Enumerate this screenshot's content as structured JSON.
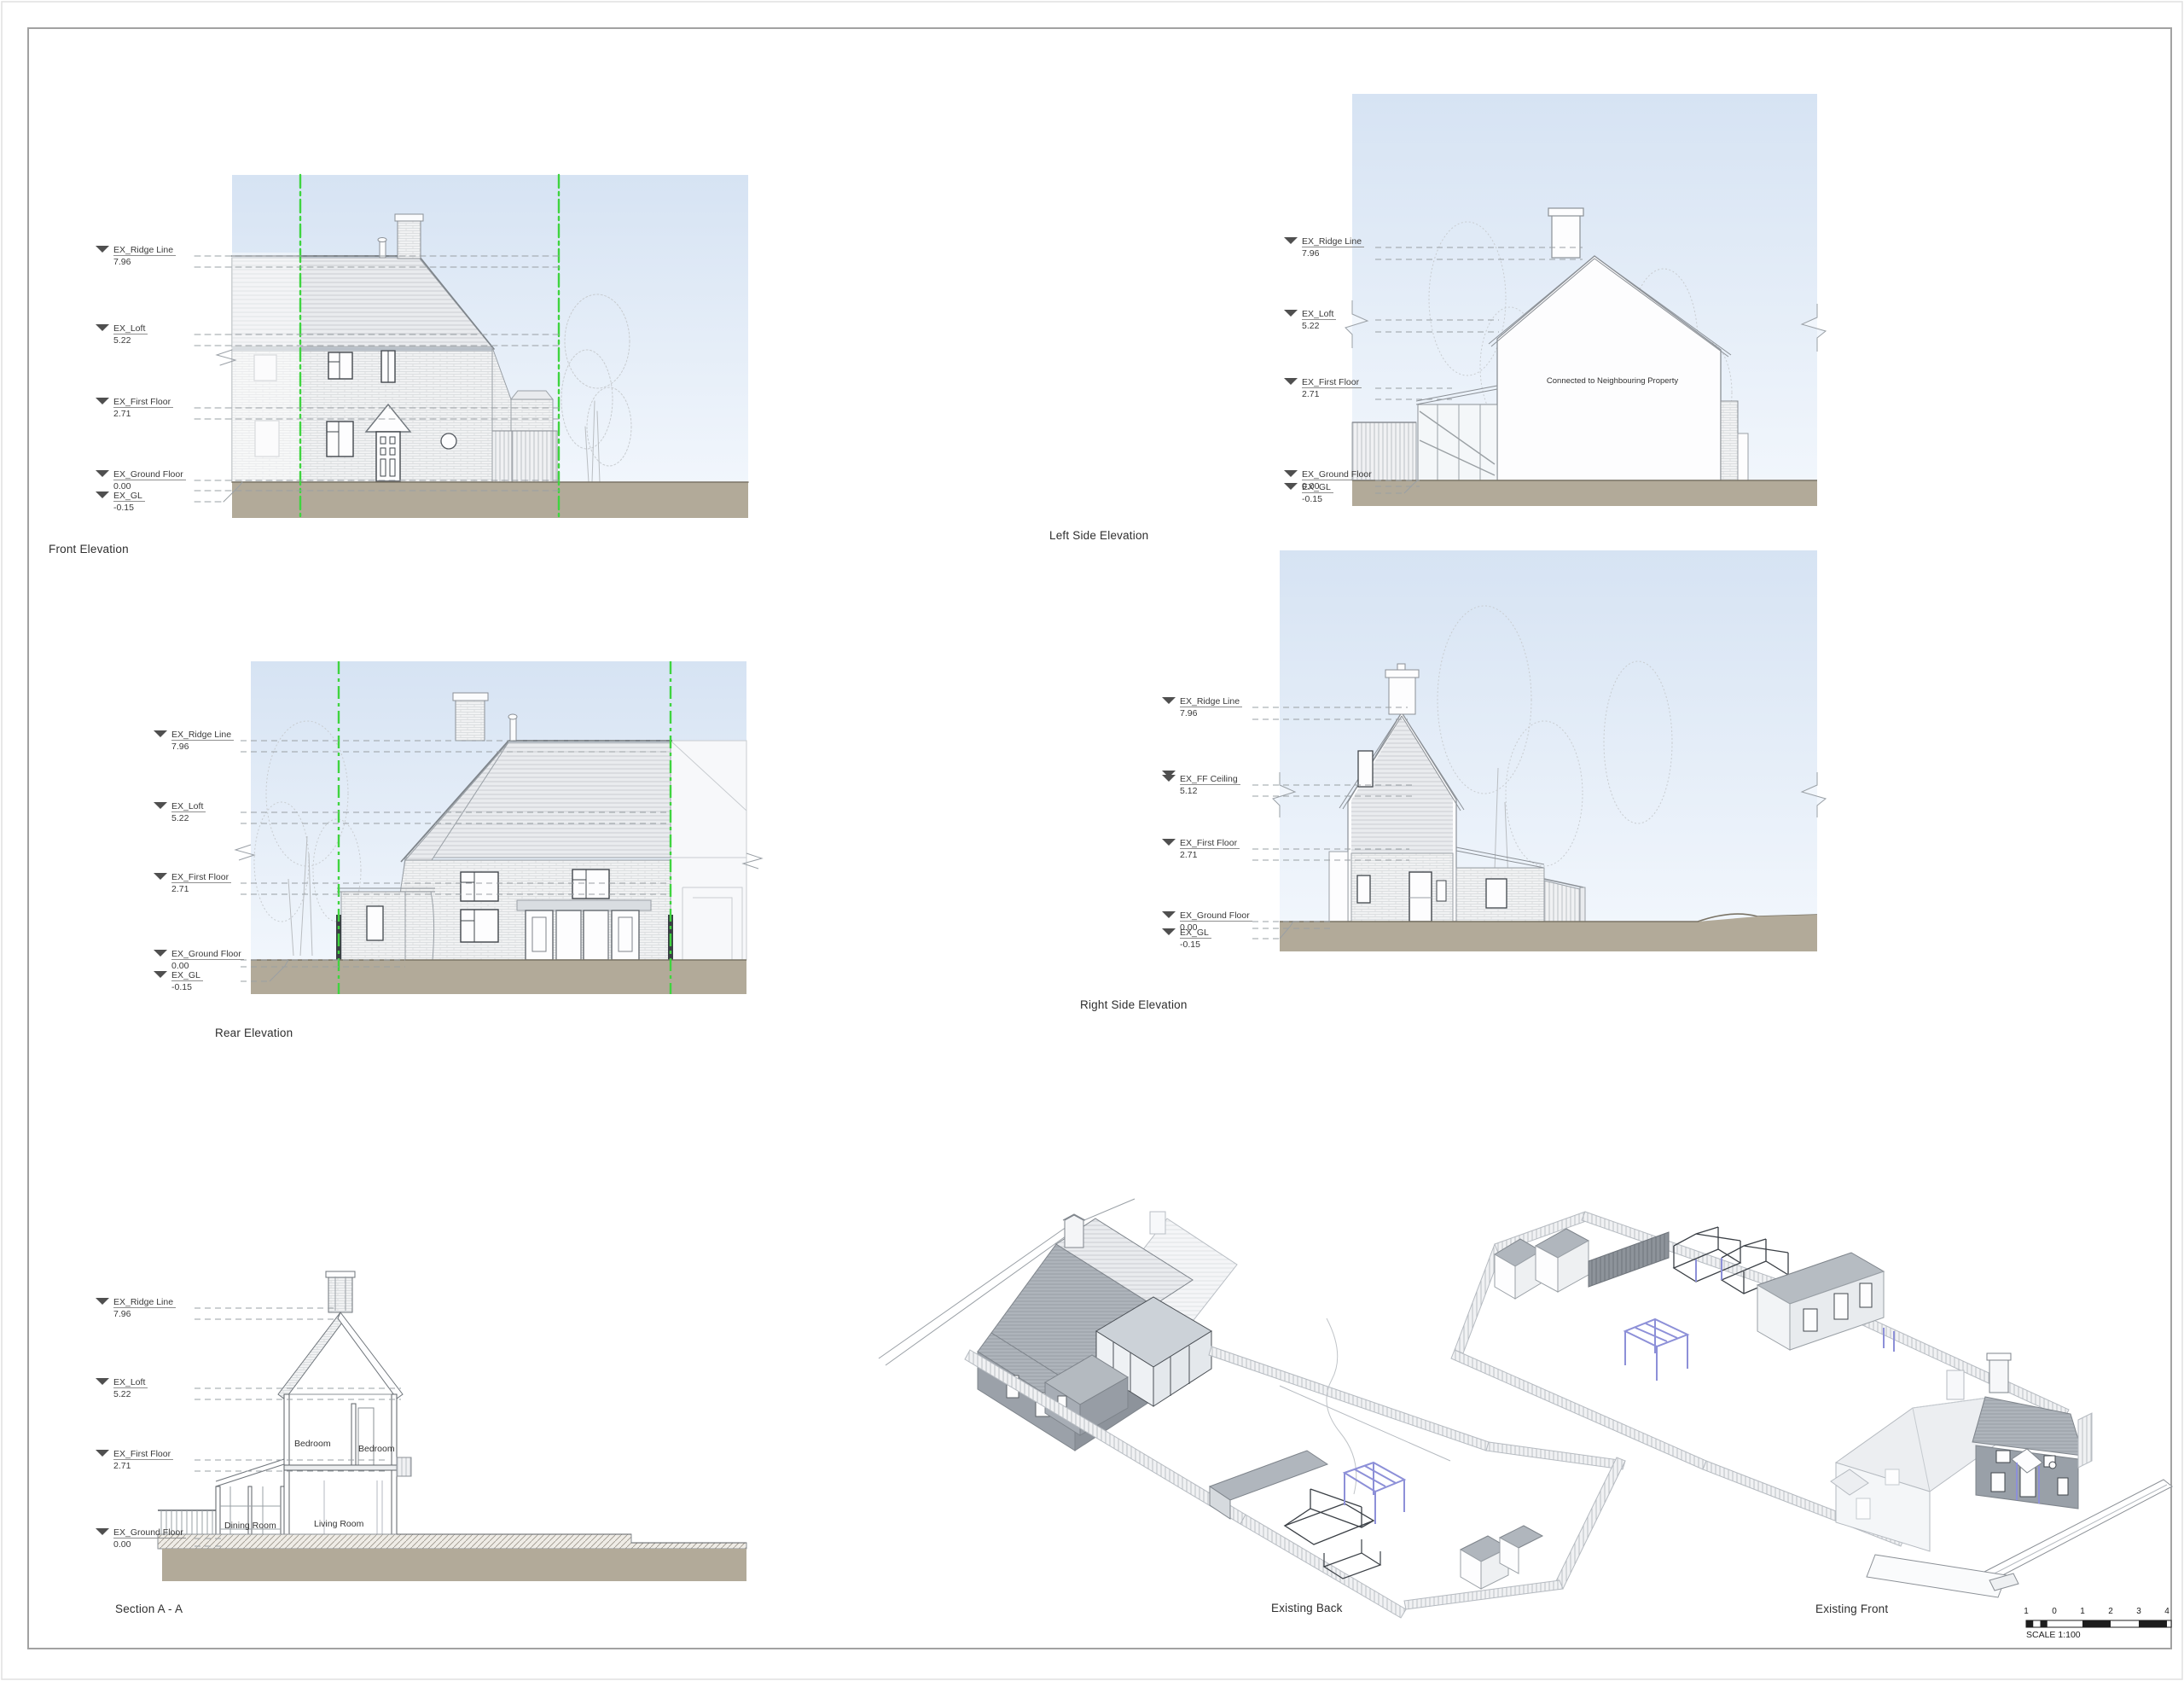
{
  "sheet": {
    "scale_label": "SCALE 1:100",
    "scale_ticks": [
      "1",
      "0",
      "1",
      "2",
      "3",
      "4"
    ]
  },
  "views": {
    "front_elevation": {
      "caption": "Front Elevation",
      "levels": [
        {
          "label": "EX_Ridge Line",
          "value": "7.96"
        },
        {
          "label": "EX_Loft",
          "value": "5.22"
        },
        {
          "label": "EX_First Floor",
          "value": "2.71"
        },
        {
          "label": "EX_Ground Floor",
          "value": "0.00"
        },
        {
          "label": "EX_GL",
          "value": "-0.15"
        }
      ]
    },
    "left_side_elevation": {
      "caption": "Left Side Elevation",
      "note": "Connected to Neighbouring Property",
      "levels": [
        {
          "label": "EX_Ridge Line",
          "value": "7.96"
        },
        {
          "label": "EX_Loft",
          "value": "5.22"
        },
        {
          "label": "EX_First Floor",
          "value": "2.71"
        },
        {
          "label": "EX_Ground Floor",
          "value": "0.00"
        },
        {
          "label": "EX_GL",
          "value": "-0.15"
        }
      ]
    },
    "rear_elevation": {
      "caption": "Rear Elevation",
      "levels": [
        {
          "label": "EX_Ridge Line",
          "value": "7.96"
        },
        {
          "label": "EX_Loft",
          "value": "5.22"
        },
        {
          "label": "EX_First Floor",
          "value": "2.71"
        },
        {
          "label": "EX_Ground Floor",
          "value": "0.00"
        },
        {
          "label": "EX_GL",
          "value": "-0.15"
        }
      ]
    },
    "right_side_elevation": {
      "caption": "Right Side Elevation",
      "levels": [
        {
          "label": "EX_Ridge Line",
          "value": "7.96"
        },
        {
          "label": "EX_FF Ceiling",
          "value": "5.12"
        },
        {
          "label": "EX_First Floor",
          "value": "2.71"
        },
        {
          "label": "EX_Ground Floor",
          "value": "0.00"
        },
        {
          "label": "EX_GL",
          "value": "-0.15"
        }
      ]
    },
    "section_aa": {
      "caption": "Section A - A",
      "levels": [
        {
          "label": "EX_Ridge Line",
          "value": "7.96"
        },
        {
          "label": "EX_Loft",
          "value": "5.22"
        },
        {
          "label": "EX_First Floor",
          "value": "2.71"
        },
        {
          "label": "EX_Ground Floor",
          "value": "0.00"
        }
      ],
      "rooms": {
        "bedroom_left": "Bedroom",
        "bedroom_right": "Bedroom",
        "dining": "Dining Room",
        "living": "Living Room"
      }
    },
    "existing_back": {
      "caption": "Existing Back"
    },
    "existing_front": {
      "caption": "Existing Front"
    }
  },
  "colors": {
    "boundary_green": "#3fd43f",
    "pergola_purple": "#8d90d8",
    "ground": "#b2aa99",
    "sky_top": "#d6e3f3",
    "sky_bottom": "#f1f6fc",
    "line_gray": "#8b9096"
  }
}
